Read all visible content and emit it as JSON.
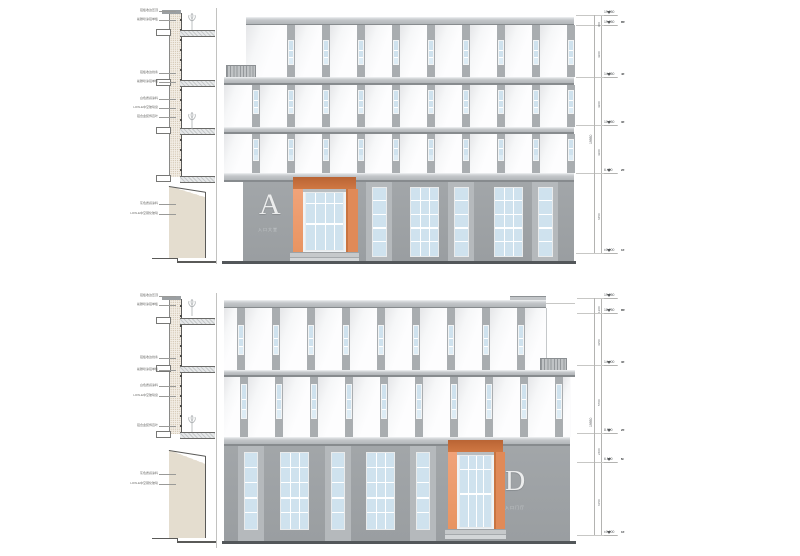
{
  "document": {
    "type": "architectural-elevation-sheet"
  },
  "colors": {
    "panel_white": "#fbfbfc",
    "panel_shade": "#e7e8ea",
    "slab_gray": "#b9bcbf",
    "slab_edge": "#878b8e",
    "window_glass": "#cfe2ee",
    "mullion_white": "#ffffff",
    "upper_strip": "#a9adb0",
    "ground_wall": "#9a9ea1",
    "ground_pilaster": "#b5b9bc",
    "portal_orange_light": "#efa077",
    "portal_orange_mid": "#e28a58",
    "portal_orange_dark": "#c06a3a",
    "ground_line": "#53575a",
    "letter_color": "#eceded",
    "hatch_beige": "#c9baa3",
    "dim_gray": "#6b6e70"
  },
  "section_labels": {
    "texts": [
      "铝板收边压顶",
      "氟碳喷涂铝单板",
      "铝板收边线条",
      "氟碳喷涂铝单板",
      "白色质感涂料",
      "LOW-E中空玻璃窗",
      "铝合金装饰百叶",
      "灰色质感涂料",
      "LOW-E中空钢化玻璃"
    ],
    "top_y": [
      11,
      20,
      73,
      82,
      99,
      108,
      117,
      204,
      214
    ],
    "bottom_y": [
      296,
      305,
      358,
      370,
      386,
      396,
      426,
      474,
      484
    ]
  },
  "elevations": {
    "top": {
      "letter": "A",
      "sub_label": "入口大堂"
    },
    "bottom": {
      "letter": "D",
      "sub_label": "入口门厅"
    }
  },
  "dimensions": {
    "top": {
      "levels": [
        {
          "y": 15,
          "value": "19.950",
          "tag": ""
        },
        {
          "y": 25,
          "value": "19.050",
          "tag": "RF"
        },
        {
          "y": 77,
          "value": "14.850",
          "tag": "4F"
        },
        {
          "y": 125,
          "value": "10.650",
          "tag": "3F"
        },
        {
          "y": 173,
          "value": "6.450",
          "tag": "2F"
        },
        {
          "y": 253,
          "value": "±0.000",
          "tag": "1F"
        }
      ],
      "segments": [
        {
          "y1": 15,
          "y2": 25,
          "label": "900"
        },
        {
          "y1": 25,
          "y2": 77,
          "label": "4200"
        },
        {
          "y1": 77,
          "y2": 125,
          "label": "4200"
        },
        {
          "y1": 125,
          "y2": 173,
          "label": "4200"
        },
        {
          "y1": 173,
          "y2": 253,
          "label": "6450"
        }
      ],
      "total": "19950"
    },
    "bottom": {
      "levels": [
        {
          "y": 298,
          "value": "19.950",
          "tag": ""
        },
        {
          "y": 313,
          "value": "18.750",
          "tag": "RF"
        },
        {
          "y": 365,
          "value": "14.400",
          "tag": "3F"
        },
        {
          "y": 433,
          "value": "8.700",
          "tag": "2F"
        },
        {
          "y": 462,
          "value": "6.150",
          "tag": "M"
        },
        {
          "y": 535,
          "value": "±0.000",
          "tag": "1F"
        }
      ],
      "segments": [
        {
          "y1": 298,
          "y2": 313,
          "label": "1200"
        },
        {
          "y1": 313,
          "y2": 365,
          "label": "4350"
        },
        {
          "y1": 365,
          "y2": 433,
          "label": "5700"
        },
        {
          "y1": 433,
          "y2": 462,
          "label": "2400"
        },
        {
          "y1": 462,
          "y2": 535,
          "label": "6150"
        }
      ],
      "total": "19950"
    }
  }
}
